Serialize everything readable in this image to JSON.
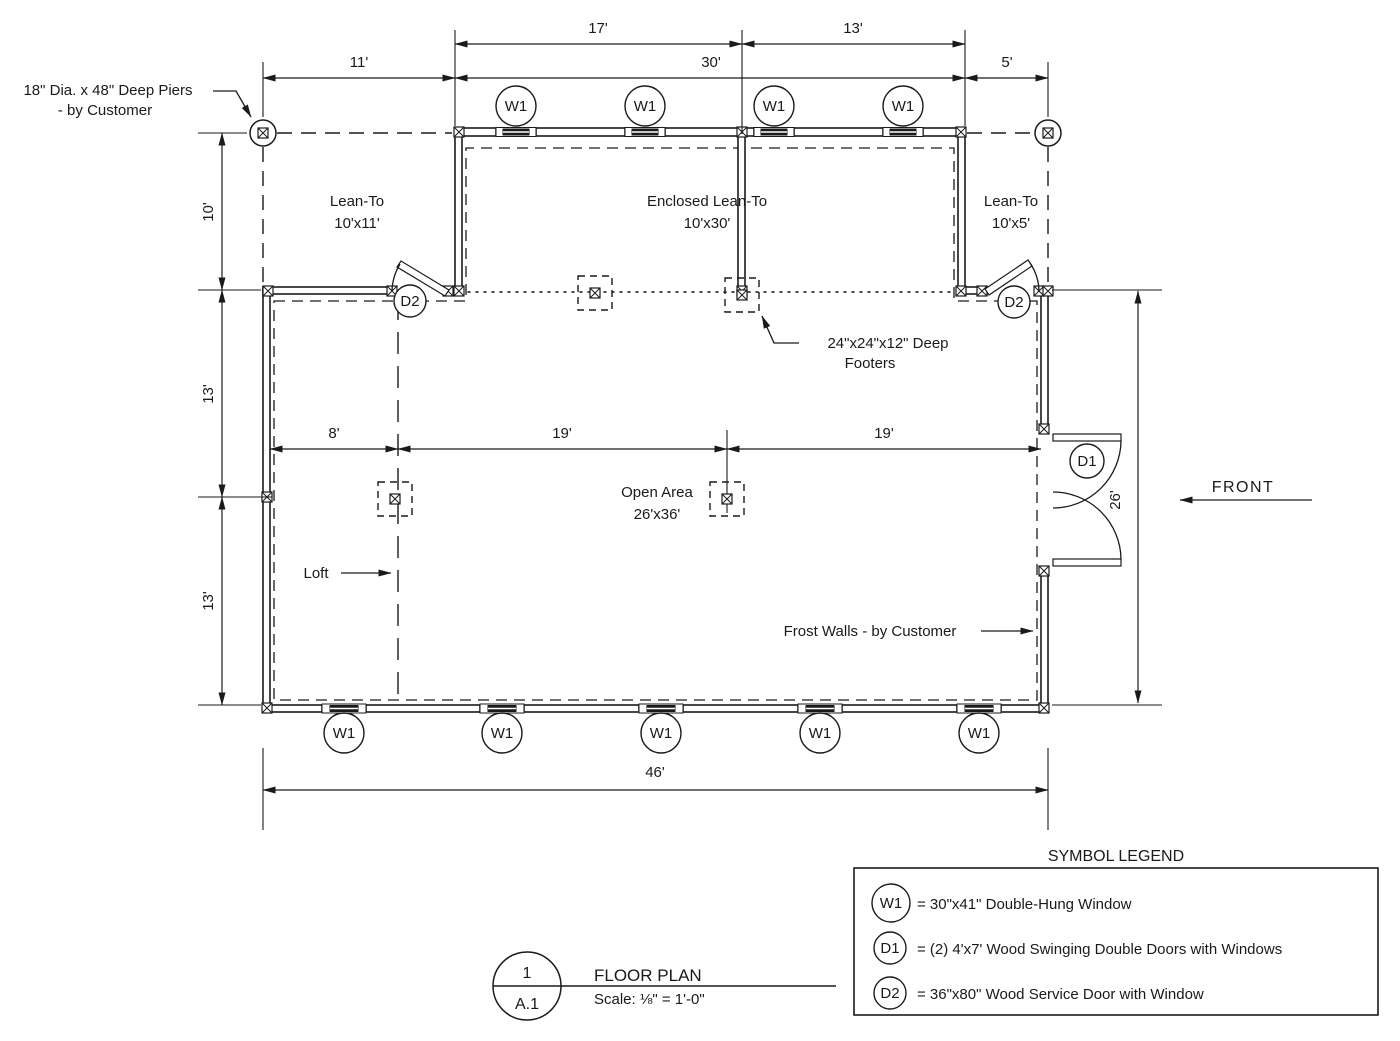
{
  "annotations": {
    "piers_line1": "18\" Dia. x 48\" Deep Piers",
    "piers_line2": "- by Customer",
    "footers_line1": "24\"x24\"x12\" Deep",
    "footers_line2": "Footers",
    "loft": "Loft",
    "frost_walls": "Frost Walls - by Customer",
    "front": "FRONT"
  },
  "rooms": {
    "lean_to_left": {
      "name": "Lean-To",
      "size": "10'x11'"
    },
    "enclosed_lean_to": {
      "name": "Enclosed Lean-To",
      "size": "10'x30'"
    },
    "lean_to_right": {
      "name": "Lean-To",
      "size": "10'x5'"
    },
    "open_area": {
      "name": "Open Area",
      "size": "26'x36'"
    }
  },
  "dimensions": {
    "top_17": "17'",
    "top_13": "13'",
    "top_11": "11'",
    "top_30": "30'",
    "top_5": "5'",
    "left_10": "10'",
    "left_13_upper": "13'",
    "left_13_lower": "13'",
    "interior_8": "8'",
    "interior_19_left": "19'",
    "interior_19_right": "19'",
    "right_26": "26'",
    "bottom_46": "46'"
  },
  "symbols": {
    "w1": "W1",
    "d1": "D1",
    "d2": "D2"
  },
  "legend": {
    "title": "SYMBOL LEGEND",
    "items": [
      {
        "tag": "W1",
        "desc": "= 30\"x41\" Double-Hung Window"
      },
      {
        "tag": "D1",
        "desc": "= (2) 4'x7' Wood Swinging Double Doors with Windows"
      },
      {
        "tag": "D2",
        "desc": "= 36\"x80\" Wood Service Door with Window"
      }
    ]
  },
  "title_block": {
    "detail_number": "1",
    "sheet": "A.1",
    "title": "FLOOR PLAN",
    "scale": "Scale: ⅛\" = 1'-0\""
  }
}
